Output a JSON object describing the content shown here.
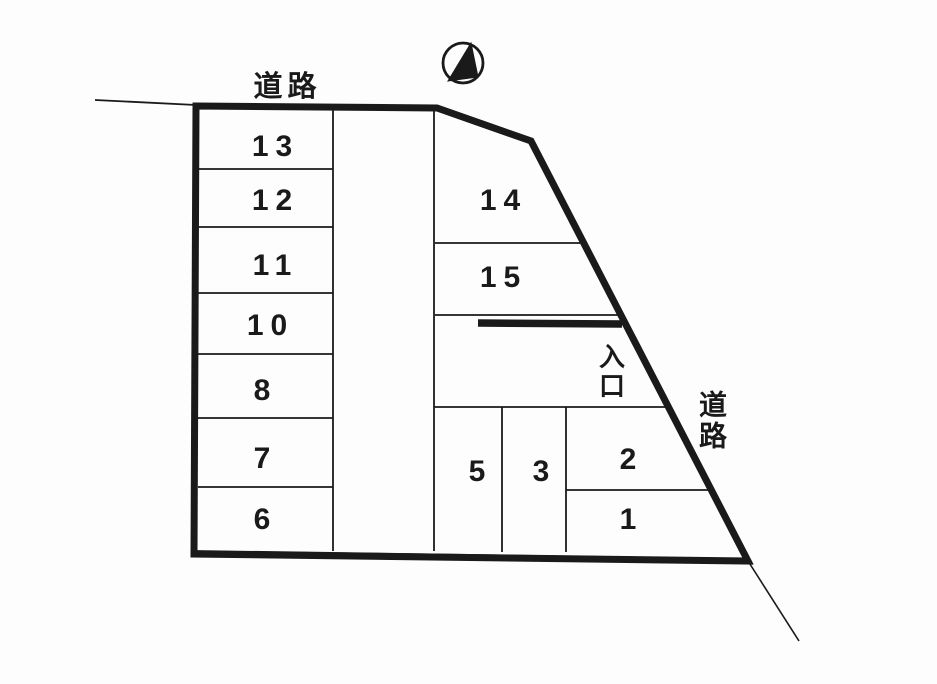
{
  "page": {
    "type": "parking-lot-layout-diagram",
    "description": "Scanned plot map of a parking lot with numbered spaces, bounded by roads on two sides"
  },
  "colors": {
    "ink": "#1a1a1a",
    "paper": "#fdfdfd"
  },
  "compass": {
    "icon": "north-arrow",
    "style": "circle with half-filled triangle pointing up"
  },
  "labels": {
    "road_top": "道路",
    "road_right": "道路",
    "entrance": "入口"
  },
  "parking": {
    "left_column_spaces": [
      "13",
      "12",
      "11",
      "10",
      "8",
      "7",
      "6"
    ],
    "center_column_spaces": [
      "14",
      "15"
    ],
    "bottom_row_spaces": [
      "5",
      "3",
      "2",
      "1"
    ]
  }
}
